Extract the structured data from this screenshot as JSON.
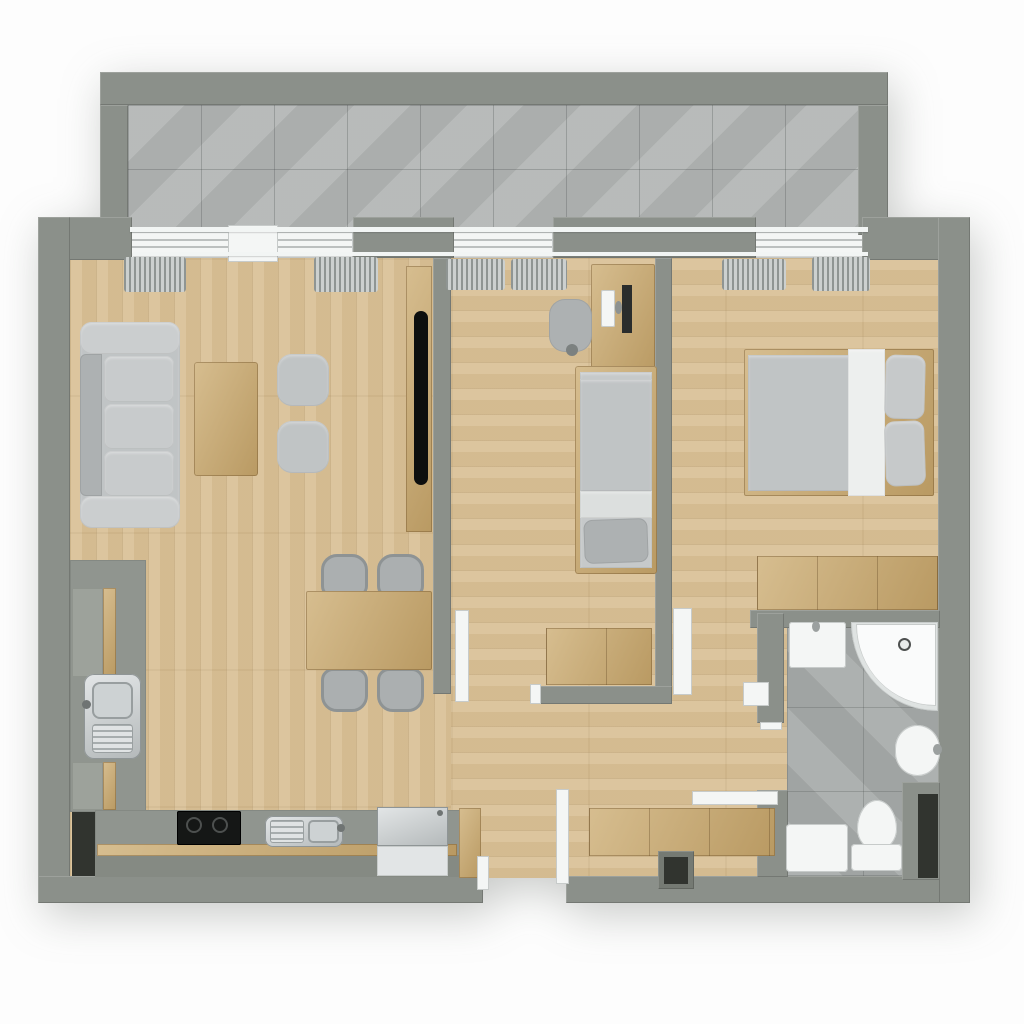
{
  "meta": {
    "canvas": {
      "width": 1024,
      "height": 1024
    },
    "background": "#fdfdfd"
  },
  "palette": {
    "wall_gray": "#8b908a",
    "wood_floor": "#d9c197",
    "furniture_wood": "#cbab70",
    "balcony_tile": "#b4b7b6",
    "bathroom_tile": "#a9adac",
    "upholstery_gray": "#c0c4c5",
    "fixture_white": "#f4f6f5",
    "appliance_steel": "#c5cacb",
    "screen_black": "#151716"
  },
  "rooms": [
    {
      "name": "balcony",
      "bounds": [
        100,
        72,
        788,
        163
      ]
    },
    {
      "name": "living-room",
      "bounds": [
        70,
        258,
        363,
        300
      ]
    },
    {
      "name": "dining-area",
      "bounds": [
        150,
        540,
        283,
        170
      ]
    },
    {
      "name": "kitchen",
      "bounds": [
        70,
        560,
        393,
        320
      ]
    },
    {
      "name": "hallway",
      "bounds": [
        451,
        704,
        306,
        174
      ]
    },
    {
      "name": "bedroom-small",
      "bounds": [
        451,
        258,
        204,
        446
      ]
    },
    {
      "name": "bedroom-master",
      "bounds": [
        672,
        258,
        266,
        352
      ]
    },
    {
      "name": "bathroom",
      "bounds": [
        784,
        628,
        156,
        249
      ]
    }
  ],
  "items": [
    {
      "name": "balcony-floor",
      "cls": "tiles-balcony",
      "rect": [
        128,
        105,
        730,
        128
      ]
    },
    {
      "name": "floor-living-dining",
      "cls": "woodfloor-v",
      "rect": [
        70,
        258,
        381,
        620
      ]
    },
    {
      "name": "floor-bedrooms-hall",
      "cls": "woodfloor-h",
      "rect": [
        451,
        258,
        489,
        620
      ]
    },
    {
      "name": "bathroom-floor",
      "cls": "tiles-bath",
      "rect": [
        787,
        623,
        153,
        254
      ]
    },
    {
      "name": "window-living",
      "cls": "window",
      "rect": [
        130,
        232,
        223,
        26
      ]
    },
    {
      "name": "window-small-bedroom",
      "cls": "window",
      "rect": [
        451,
        232,
        102,
        26
      ]
    },
    {
      "name": "window-master",
      "cls": "window",
      "rect": [
        755,
        232,
        113,
        26
      ]
    },
    {
      "name": "window-open-slider",
      "cls": "white",
      "rect": [
        228,
        225,
        50,
        37
      ]
    },
    {
      "name": "balcony-wall-top",
      "cls": "wall",
      "rect": [
        100,
        72,
        788,
        33
      ]
    },
    {
      "name": "balcony-wall-left",
      "cls": "wall",
      "rect": [
        100,
        105,
        28,
        130
      ]
    },
    {
      "name": "balcony-wall-right",
      "cls": "wall",
      "rect": [
        858,
        105,
        30,
        130
      ]
    },
    {
      "name": "north-wall-west",
      "cls": "wall",
      "rect": [
        38,
        217,
        94,
        43
      ]
    },
    {
      "name": "north-wall-pier-1",
      "cls": "wall",
      "rect": [
        353,
        217,
        101,
        41
      ]
    },
    {
      "name": "north-wall-pier-2",
      "cls": "wall",
      "rect": [
        553,
        217,
        203,
        41
      ]
    },
    {
      "name": "north-wall-east",
      "cls": "wall",
      "rect": [
        862,
        217,
        108,
        43
      ]
    },
    {
      "name": "outer-wall-west",
      "cls": "wall",
      "rect": [
        38,
        217,
        32,
        686
      ]
    },
    {
      "name": "outer-wall-east",
      "cls": "wall",
      "rect": [
        938,
        217,
        32,
        686
      ]
    },
    {
      "name": "outer-wall-south-west",
      "cls": "wall",
      "rect": [
        38,
        876,
        445,
        27
      ]
    },
    {
      "name": "outer-wall-south-east",
      "cls": "wall",
      "rect": [
        566,
        876,
        374,
        27
      ]
    },
    {
      "name": "wall-living-small-bedroom",
      "cls": "wall",
      "rect": [
        433,
        258,
        18,
        436
      ]
    },
    {
      "name": "wall-small-master-bedroom",
      "cls": "wall",
      "rect": [
        655,
        258,
        17,
        446
      ]
    },
    {
      "name": "wall-small-bedroom-south",
      "cls": "wall",
      "rect": [
        532,
        686,
        140,
        18
      ]
    },
    {
      "name": "wall-bathroom-north",
      "cls": "wall",
      "rect": [
        750,
        610,
        190,
        18
      ]
    },
    {
      "name": "wall-bathroom-west-upper",
      "cls": "wall",
      "rect": [
        757,
        613,
        27,
        110
      ]
    },
    {
      "name": "wall-bathroom-west-lower",
      "cls": "wall",
      "rect": [
        757,
        790,
        31,
        87
      ]
    },
    {
      "name": "bathroom-tall-cabinet",
      "cls": "wall",
      "rect": [
        902,
        782,
        38,
        98
      ]
    },
    {
      "name": "bathroom-cabinet-niche",
      "cls": "dark",
      "rect": [
        918,
        794,
        20,
        84
      ]
    },
    {
      "name": "balcony-rail",
      "cls": "rail",
      "rect": [
        130,
        227,
        738,
        5
      ]
    },
    {
      "name": "curtain-rail",
      "cls": "rail",
      "rect": [
        133,
        252,
        735,
        4
      ]
    },
    {
      "name": "curtain-living-left",
      "cls": "curtain",
      "rect": [
        124,
        257,
        62,
        35
      ]
    },
    {
      "name": "curtain-living-right",
      "cls": "curtain",
      "rect": [
        314,
        257,
        64,
        35
      ]
    },
    {
      "name": "curtain-small-left",
      "cls": "curtain",
      "rect": [
        446,
        259,
        59,
        31
      ]
    },
    {
      "name": "curtain-small-right",
      "cls": "curtain",
      "rect": [
        511,
        259,
        56,
        31
      ]
    },
    {
      "name": "curtain-master-left",
      "cls": "curtain",
      "rect": [
        722,
        259,
        64,
        31
      ]
    },
    {
      "name": "curtain-master-right",
      "cls": "curtain",
      "rect": [
        812,
        257,
        58,
        34
      ]
    },
    {
      "name": "sofa",
      "cls": "fabric",
      "rect": [
        80,
        322,
        100,
        206
      ],
      "r": "12px"
    },
    {
      "name": "sofa-armrest-top",
      "cls": "fabric",
      "rect": [
        80,
        322,
        100,
        32
      ],
      "r": "12px",
      "bg": "#cbcecf"
    },
    {
      "name": "sofa-armrest-bottom",
      "cls": "fabric",
      "rect": [
        80,
        496,
        100,
        32
      ],
      "r": "12px",
      "bg": "#cbcecf"
    },
    {
      "name": "sofa-backrest",
      "cls": "fabric-d",
      "rect": [
        80,
        354,
        22,
        142
      ],
      "r": "6px 0 0 6px"
    },
    {
      "name": "sofa-cushion-1",
      "cls": "fabric",
      "rect": [
        104,
        356,
        70,
        46
      ],
      "r": "8px",
      "bg": "#c8cbcc"
    },
    {
      "name": "sofa-cushion-2",
      "cls": "fabric",
      "rect": [
        104,
        404,
        70,
        45
      ],
      "r": "8px",
      "bg": "#c8cbcc"
    },
    {
      "name": "sofa-cushion-3",
      "cls": "fabric",
      "rect": [
        104,
        451,
        70,
        45
      ],
      "r": "8px",
      "bg": "#c8cbcc"
    },
    {
      "name": "coffee-table",
      "cls": "wood",
      "rect": [
        194,
        362,
        64,
        114
      ],
      "r": "3px"
    },
    {
      "name": "pouf-1",
      "cls": "fabric",
      "rect": [
        277,
        354,
        52,
        52
      ],
      "r": "15px"
    },
    {
      "name": "pouf-2",
      "cls": "fabric",
      "rect": [
        277,
        421,
        52,
        52
      ],
      "r": "15px"
    },
    {
      "name": "tv-panel",
      "cls": "wood",
      "rect": [
        406,
        266,
        26,
        266
      ]
    },
    {
      "name": "tv-screen",
      "cls": "tv",
      "rect": [
        414,
        311,
        14,
        174
      ]
    },
    {
      "name": "dining-chair-1",
      "cls": "chair",
      "rect": [
        321,
        554,
        47,
        44
      ],
      "r": "16px 16px 12px 12px"
    },
    {
      "name": "dining-chair-2",
      "cls": "chair",
      "rect": [
        377,
        554,
        47,
        44
      ],
      "r": "16px 16px 12px 12px"
    },
    {
      "name": "dining-chair-3",
      "cls": "chair",
      "rect": [
        321,
        668,
        47,
        44
      ],
      "r": "12px 12px 16px 16px"
    },
    {
      "name": "dining-chair-4",
      "cls": "chair",
      "rect": [
        377,
        668,
        47,
        44
      ],
      "r": "12px 12px 16px 16px"
    },
    {
      "name": "dining-table",
      "cls": "wood",
      "rect": [
        306,
        591,
        126,
        79
      ],
      "r": "2px"
    },
    {
      "name": "kitchen-counter-west",
      "cls": "counter",
      "rect": [
        70,
        560,
        76,
        252
      ]
    },
    {
      "name": "kitchen-cabinet-upper",
      "cls": "counter-light",
      "rect": [
        72,
        588,
        31,
        89
      ]
    },
    {
      "name": "kitchen-cabinet-upper-front",
      "cls": "wood",
      "rect": [
        103,
        588,
        13,
        89
      ]
    },
    {
      "name": "kitchen-sink",
      "cls": "steel",
      "rect": [
        84,
        674,
        57,
        85
      ],
      "r": "10px"
    },
    {
      "name": "kitchen-sink-bowl",
      "cls": "steel-inner",
      "rect": [
        92,
        682,
        41,
        37
      ],
      "r": "8px"
    },
    {
      "name": "kitchen-sink-drainboard",
      "cls": "stripes",
      "rect": [
        92,
        724,
        41,
        29
      ],
      "r": "4px"
    },
    {
      "name": "kitchen-faucet",
      "cls": "dot",
      "rect": [
        82,
        700,
        9,
        9
      ]
    },
    {
      "name": "kitchen-cabinet-lower",
      "cls": "counter-light",
      "rect": [
        72,
        762,
        31,
        48
      ]
    },
    {
      "name": "kitchen-cabinet-lower-front",
      "cls": "wood",
      "rect": [
        103,
        762,
        13,
        48
      ]
    },
    {
      "name": "kitchen-niche",
      "cls": "dark",
      "rect": [
        72,
        812,
        23,
        64
      ]
    },
    {
      "name": "kitchen-counter-south",
      "cls": "counter",
      "rect": [
        95,
        810,
        368,
        46
      ]
    },
    {
      "name": "kitchen-plinth",
      "cls": "wood",
      "rect": [
        97,
        844,
        360,
        12
      ]
    },
    {
      "name": "kitchen-base-south",
      "cls": "base",
      "rect": [
        95,
        856,
        368,
        21
      ]
    },
    {
      "name": "kitchen-counter-endcap",
      "cls": "wood",
      "rect": [
        459,
        808,
        22,
        70
      ]
    },
    {
      "name": "cooktop",
      "cls": "black",
      "rect": [
        177,
        811,
        64,
        34
      ],
      "r": "2px"
    },
    {
      "name": "cooktop-burner-1",
      "cls": "ring",
      "rect": [
        186,
        817,
        16,
        16
      ]
    },
    {
      "name": "cooktop-burner-2",
      "cls": "ring",
      "rect": [
        212,
        817,
        16,
        16
      ]
    },
    {
      "name": "kitchen-sink-2",
      "cls": "steel",
      "rect": [
        265,
        816,
        78,
        31
      ],
      "r": "8px"
    },
    {
      "name": "sink-2-drainboard",
      "cls": "stripes",
      "rect": [
        270,
        820,
        34,
        23
      ],
      "r": "3px"
    },
    {
      "name": "sink-2-bowl",
      "cls": "steel-inner",
      "rect": [
        308,
        820,
        31,
        23
      ],
      "r": "5px"
    },
    {
      "name": "sink-2-faucet",
      "cls": "dot",
      "rect": [
        337,
        824,
        8,
        8
      ]
    },
    {
      "name": "refrigerator",
      "cls": "steel",
      "rect": [
        377,
        807,
        71,
        39
      ]
    },
    {
      "name": "refrigerator-front",
      "cls": "white",
      "rect": [
        377,
        846,
        71,
        30
      ],
      "bg": "#e2e5e6"
    },
    {
      "name": "refrigerator-handle",
      "cls": "dot",
      "rect": [
        437,
        810,
        6,
        6
      ]
    },
    {
      "name": "desk",
      "cls": "wood",
      "rect": [
        591,
        264,
        64,
        114
      ],
      "r": "2px"
    },
    {
      "name": "desk-chair",
      "cls": "fabric-d",
      "rect": [
        549,
        299,
        43,
        53
      ],
      "r": "16px"
    },
    {
      "name": "desk-chair-base",
      "cls": "dot",
      "rect": [
        566,
        344,
        12,
        12
      ],
      "bg": "#7c8180"
    },
    {
      "name": "desk-keyboard",
      "cls": "white",
      "rect": [
        601,
        290,
        14,
        37
      ],
      "r": "2px"
    },
    {
      "name": "desk-monitor",
      "cls": "dark",
      "rect": [
        622,
        285,
        10,
        48
      ],
      "bg": "#2a2d2c"
    },
    {
      "name": "desk-monitor-stand",
      "cls": "dot",
      "rect": [
        615,
        301,
        7,
        13
      ],
      "bg": "#8d9291"
    },
    {
      "name": "single-bed-frame",
      "cls": "wood",
      "rect": [
        575,
        366,
        82,
        208
      ],
      "r": "3px"
    },
    {
      "name": "single-bed-mattress",
      "cls": "fabric",
      "rect": [
        580,
        372,
        72,
        196
      ],
      "bg": "#c6c9ca"
    },
    {
      "name": "single-bed-duvet",
      "cls": "fabric",
      "rect": [
        580,
        379,
        72,
        112
      ]
    },
    {
      "name": "single-bed-sheet",
      "cls": "fabric",
      "rect": [
        580,
        491,
        72,
        27
      ],
      "bg": "#dcdfde"
    },
    {
      "name": "single-bed-pillow",
      "cls": "fabric-d",
      "rect": [
        584,
        519,
        64,
        44
      ],
      "r": "9px",
      "tr": "rotate(-2deg)"
    },
    {
      "name": "chest-small-bedroom",
      "cls": "wood seams",
      "rect": [
        546,
        628,
        106,
        57
      ]
    },
    {
      "name": "door-frame-small-bedroom",
      "cls": "white",
      "rect": [
        530,
        684,
        11,
        20
      ]
    },
    {
      "name": "master-bed-frame",
      "cls": "wood",
      "rect": [
        744,
        349,
        190,
        147
      ],
      "r": "2px"
    },
    {
      "name": "master-bed-duvet",
      "cls": "fabric",
      "rect": [
        748,
        355,
        103,
        136
      ]
    },
    {
      "name": "master-bed-blanket",
      "cls": "fabric",
      "rect": [
        848,
        349,
        37,
        147
      ],
      "bg": "#edefee"
    },
    {
      "name": "master-pillow-1",
      "cls": "fabric",
      "rect": [
        885,
        355,
        40,
        64
      ],
      "r": "10px",
      "bg": "#c6c9ca",
      "tr": "rotate(1.5deg)"
    },
    {
      "name": "master-pillow-2",
      "cls": "fabric",
      "rect": [
        885,
        421,
        40,
        65
      ],
      "r": "10px",
      "bg": "#c6c9ca",
      "tr": "rotate(-2deg)"
    },
    {
      "name": "master-dresser",
      "cls": "wood seams",
      "rect": [
        757,
        556,
        181,
        54
      ]
    },
    {
      "name": "washbasin",
      "cls": "white",
      "rect": [
        789,
        622,
        57,
        46
      ],
      "r": "3px"
    },
    {
      "name": "washbasin-faucet",
      "cls": "dot",
      "rect": [
        812,
        621,
        8,
        11
      ],
      "bg": "#9ba09f"
    },
    {
      "name": "shower-tray",
      "cls": "white",
      "rect": [
        851,
        622,
        87,
        89
      ],
      "r": "0 0 0 100%",
      "bg": "#dfe3e2"
    },
    {
      "name": "shower-tray-inner",
      "cls": "white",
      "rect": [
        856,
        624,
        80,
        82
      ],
      "r": "0 0 0 100%",
      "bg": "#fafbfb"
    },
    {
      "name": "shower-drain",
      "cls": "ring",
      "rect": [
        898,
        638,
        13,
        13
      ],
      "bg": "#e8ebea"
    },
    {
      "name": "bidet",
      "cls": "white",
      "rect": [
        895,
        725,
        45,
        51
      ],
      "r": "50% / 46%"
    },
    {
      "name": "bidet-faucet",
      "cls": "dot",
      "rect": [
        933,
        744,
        9,
        11
      ],
      "bg": "#9ba09f"
    },
    {
      "name": "toilet-bowl",
      "cls": "white",
      "rect": [
        857,
        800,
        40,
        50
      ],
      "r": "50% 50% 46% 46% / 58% 58% 42% 42%"
    },
    {
      "name": "toilet-tank",
      "cls": "white",
      "rect": [
        851,
        844,
        51,
        27
      ],
      "r": "4px"
    },
    {
      "name": "washing-machine",
      "cls": "white",
      "rect": [
        786,
        824,
        62,
        48
      ],
      "r": "4px"
    },
    {
      "name": "hall-shelf",
      "cls": "white",
      "rect": [
        743,
        682,
        26,
        24
      ]
    },
    {
      "name": "hall-sideboard",
      "cls": "wood seams",
      "rect": [
        589,
        808,
        186,
        48
      ]
    },
    {
      "name": "entry-niche-frame",
      "cls": "wall",
      "rect": [
        658,
        851,
        36,
        38
      ],
      "bg": "#757a73"
    },
    {
      "name": "entry-niche",
      "cls": "dark",
      "rect": [
        664,
        857,
        24,
        27
      ]
    },
    {
      "name": "entry-door-jamb",
      "cls": "white",
      "rect": [
        477,
        856,
        12,
        34
      ]
    },
    {
      "name": "entry-door",
      "cls": "white",
      "rect": [
        556,
        789,
        13,
        95
      ]
    },
    {
      "name": "door-small-bedroom",
      "cls": "white",
      "rect": [
        455,
        610,
        14,
        92
      ]
    },
    {
      "name": "door-master-bedroom",
      "cls": "white",
      "rect": [
        673,
        608,
        19,
        87
      ]
    },
    {
      "name": "door-bathroom",
      "cls": "white",
      "rect": [
        692,
        791,
        86,
        14
      ]
    },
    {
      "name": "door-frame-bathroom",
      "cls": "white",
      "rect": [
        760,
        722,
        22,
        8
      ]
    }
  ]
}
